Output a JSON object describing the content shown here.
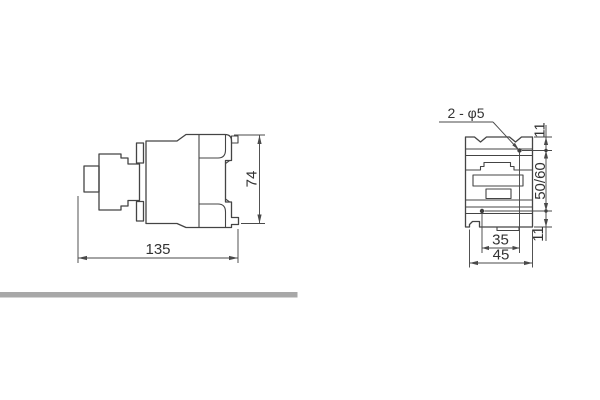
{
  "side_view": {
    "width": "135",
    "height": "74"
  },
  "front_view": {
    "hole_callout": "2 - φ5",
    "offset_top": "11",
    "mount_height": "50/60",
    "offset_bottom": "11",
    "hole_spacing": "35",
    "width": "45"
  },
  "colors": {
    "line": "#444444",
    "divider_bar": "#a8a8a8"
  }
}
